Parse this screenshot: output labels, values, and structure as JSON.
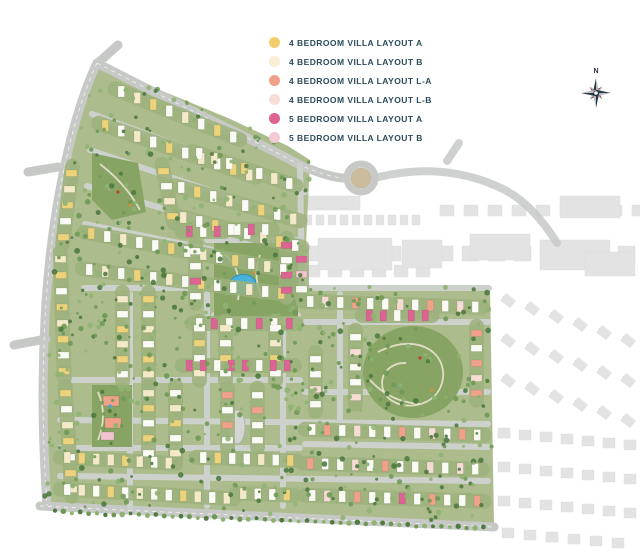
{
  "legend": {
    "items": [
      {
        "label": "4 BEDROOM VILLA LAYOUT A",
        "color": "#F1CE6E",
        "key": "Y"
      },
      {
        "label": "4 BEDROOM VILLA LAYOUT B",
        "color": "#F9EED2",
        "key": "C"
      },
      {
        "label": "4 BEDROOM VILLA LAYOUT L-A",
        "color": "#EFA189",
        "key": "S"
      },
      {
        "label": "4 BEDROOM VILLA LAYOUT L-B",
        "color": "#F8DCD6",
        "key": "P"
      },
      {
        "label": "5 BEDROOM VILLA LAYOUT A",
        "color": "#DB6492",
        "key": "M"
      },
      {
        "label": "5 BEDROOM VILLA LAYOUT B",
        "color": "#F4CBD4",
        "key": "R"
      }
    ]
  },
  "compass": {
    "north_label": "N"
  },
  "map": {
    "palette": {
      "Y": "#ECD27A",
      "C": "#F4EACA",
      "S": "#EFA189",
      "P": "#F6DCD4",
      "M": "#DB6492",
      "R": "#F2C3CE",
      "W": "#FBFBF5",
      "ground": "#ADBC8D",
      "street": "#CDD1CC",
      "road": "#C6C9C6",
      "strip": "#9DB27D",
      "park": "#87A464",
      "parkPath": "#E9E4CF",
      "water": "#48B2DA",
      "waterEdge": "#2E8CB8",
      "roundaboutCenter": "#CBBC9E",
      "context": "#C2C2C2",
      "contextRoad": "#C7C9C8",
      "trees": [
        "#4F7A40",
        "#6F9A55",
        "#8FB272"
      ],
      "island": "#D3D6D2",
      "islandEdge": "#AFB5AD"
    },
    "site_polygon": [
      [
        97,
        62
      ],
      [
        160,
        90
      ],
      [
        228,
        118
      ],
      [
        288,
        146
      ],
      [
        310,
        160
      ],
      [
        304,
        286
      ],
      [
        490,
        286
      ],
      [
        494,
        525
      ],
      [
        42,
        505
      ],
      [
        44,
        420
      ],
      [
        47,
        330
      ],
      [
        58,
        226
      ],
      [
        78,
        122
      ]
    ],
    "roads": [
      "M97,63 C160,96 242,134 302,166 C324,175 336,178 346,178",
      "M97,63 C70,120 50,220 45,320 C41,400 44,460 47,506",
      "M40,506 C160,512 300,518 494,527",
      "M99,62 L118,45",
      "M28,172 L58,167",
      "M14,345 L46,339"
    ],
    "context_roads": [
      "M375,178 C420,166 464,170 503,189 C527,201 544,222 557,243",
      "M447,161 L459,143"
    ],
    "roundabout": {
      "cx": 361,
      "cy": 178,
      "outer": 14,
      "inner": 10
    },
    "streets": [
      "M92,114 L305,192",
      "M90,150 L303,222",
      "M87,186 L302,250",
      "M85,224 L302,268",
      "M84,288 L489,288",
      "M130,294 L130,506",
      "M207,294 L207,506",
      "M283,320 L283,506",
      "M300,165 L302,288",
      "M207,240 L298,240",
      "M60,380 L300,380",
      "M305,322 L488,322",
      "M305,392 L488,392",
      "M60,420 L488,424",
      "M60,448 L300,448",
      "M305,444 L488,447",
      "M60,476 L488,481",
      "M340,294 L340,420",
      "M214,315 L298,315"
    ],
    "island": {
      "cx": 237,
      "cy": 427,
      "rx": 8,
      "ry": 17
    },
    "parks": [
      {
        "type": "poly",
        "pts": "92,153 138,163 146,212 112,220 92,200"
      },
      {
        "type": "rect",
        "x": 214,
        "y": 243,
        "w": 84,
        "h": 74
      },
      {
        "type": "rect",
        "x": 92,
        "y": 385,
        "w": 40,
        "h": 62
      },
      {
        "type": "ellipse",
        "cx": 413,
        "cy": 372,
        "rx": 50,
        "ry": 46
      }
    ],
    "park_paths": [
      "M100,164 Q126,184 140,210",
      "M222,252 Q244,268 238,300",
      "M260,255 Q252,275 262,298",
      "M98,392 Q108,415 98,440",
      "M378,352 C420,330 452,356 441,386 C432,410 394,412 384,392 C377,376 390,362 406,363",
      "M370,380 Q390,402 420,404"
    ],
    "park_buildings": [
      {
        "x": 103,
        "y": 396,
        "w": 16,
        "h": 10,
        "key": "S"
      },
      {
        "x": 105,
        "y": 418,
        "w": 16,
        "h": 10,
        "key": "S"
      },
      {
        "x": 101,
        "y": 432,
        "w": 13,
        "h": 8,
        "key": "R"
      }
    ],
    "pond": {
      "cx": 243,
      "cy": 284,
      "rx": 13,
      "ry": 9.5
    },
    "specks": [
      [
        118,
        192,
        "#B8432F"
      ],
      [
        130,
        205,
        "#D98F3E"
      ],
      [
        255,
        260,
        "#B8432F"
      ],
      [
        228,
        262,
        "#3FA8D8"
      ],
      [
        420,
        358,
        "#B8432F"
      ],
      [
        400,
        386,
        "#3FA8D8"
      ],
      [
        432,
        390,
        "#D98F3E"
      ],
      [
        110,
        406,
        "#3FA8D8"
      ],
      [
        254,
        272,
        "#D98F3E"
      ]
    ],
    "villa_rows": [
      [
        118,
        86,
        16,
        6.5,
        8,
        "v",
        "WCYWCWYW"
      ],
      [
        102,
        120,
        16,
        5.5,
        10,
        "v",
        "YWCWYWCWYC"
      ],
      [
        196,
        148,
        15,
        5,
        7,
        "v",
        "WCWYWCW"
      ],
      [
        158,
        168,
        3,
        15,
        4,
        "h",
        "YWCY"
      ],
      [
        178,
        182,
        16,
        4.5,
        8,
        "v",
        "WYWCWYWC"
      ],
      [
        180,
        212,
        16,
        4,
        8,
        "v",
        "CWYWWCYW"
      ],
      [
        88,
        228,
        16,
        3,
        13,
        "v",
        "YWCWWYWCWYWCW"
      ],
      [
        86,
        264,
        16,
        2,
        13,
        "v",
        "WCWYWCWYWWCWY"
      ],
      [
        66,
        170,
        -2,
        16,
        5,
        "h",
        "YCYWY"
      ],
      [
        55,
        256,
        0.5,
        16,
        8,
        "h",
        "CYWYCYWY"
      ],
      [
        60,
        390,
        1,
        16,
        7,
        "h",
        "YWCYWYC"
      ],
      [
        186,
        226,
        14,
        0,
        3,
        "v",
        "MWM"
      ],
      [
        234,
        224,
        14,
        0,
        3,
        "v",
        "WMW"
      ],
      [
        190,
        248,
        0,
        15,
        4,
        "h",
        "WWMW"
      ],
      [
        281,
        242,
        0,
        15,
        4,
        "h",
        "MWMM"
      ],
      [
        296,
        256,
        0,
        15,
        3,
        "h",
        "MRW"
      ],
      [
        196,
        318,
        15,
        0,
        4,
        "v",
        "WMWW"
      ],
      [
        256,
        318,
        15,
        0,
        3,
        "v",
        "MWM"
      ],
      [
        307,
        296,
        15,
        0.5,
        12,
        "v",
        "WPWSWWPWSWPW"
      ],
      [
        366,
        310,
        14,
        0,
        5,
        "v",
        "MMWMM"
      ],
      [
        350,
        334,
        0,
        15,
        5,
        "h",
        "WPWWP"
      ],
      [
        471,
        330,
        0,
        15,
        5,
        "h",
        "SWSPS"
      ],
      [
        310,
        356,
        0,
        15,
        4,
        "h",
        "WWPW"
      ],
      [
        309,
        424,
        15,
        0.5,
        12,
        "v",
        "WSWPWWSWPWSW"
      ],
      [
        307,
        458,
        15,
        0.5,
        12,
        "v",
        "SWWPWSWWPWPW"
      ],
      [
        309,
        490,
        15,
        0.5,
        12,
        "v",
        "WPWSWWMWSWWS"
      ],
      [
        117,
        296,
        0,
        15,
        6,
        "h",
        "CWYCYW"
      ],
      [
        143,
        296,
        0,
        15,
        6,
        "h",
        "YWCWYC"
      ],
      [
        194,
        325,
        0,
        15,
        4,
        "h",
        "WYWC"
      ],
      [
        220,
        325,
        0,
        15,
        4,
        "h",
        "CWYW"
      ],
      [
        270,
        325,
        0,
        15,
        4,
        "h",
        "WCYW"
      ],
      [
        186,
        360,
        14,
        0,
        8,
        "v",
        "MMWMMWMM"
      ],
      [
        143,
        390,
        0,
        15,
        5,
        "h",
        "CYWYW"
      ],
      [
        170,
        390,
        0,
        15,
        5,
        "h",
        "WCYWC"
      ],
      [
        222,
        392,
        0,
        15,
        4,
        "h",
        "SWSW"
      ],
      [
        252,
        392,
        0,
        15,
        4,
        "h",
        "WSWW"
      ],
      [
        64,
        452,
        14.5,
        0.8,
        8,
        "v",
        "CYCCYCWC"
      ],
      [
        200,
        452,
        14.5,
        0.5,
        7,
        "v",
        "WYWWCWY"
      ],
      [
        64,
        484,
        14.5,
        0.8,
        12,
        "v",
        "WCWYWCWWYCWC"
      ],
      [
        240,
        488,
        14.5,
        0.5,
        4,
        "v",
        "CWWY"
      ]
    ],
    "context_strips": [
      {
        "x0": 304,
        "y": 215,
        "x1": 418,
        "step": 12,
        "w": 8,
        "h": 10
      },
      {
        "x0": 306,
        "y": 246,
        "x1": 644,
        "step": 26,
        "w": 17,
        "h": 15
      },
      {
        "x0": 440,
        "y": 205,
        "x1": 640,
        "step": 24,
        "w": 14,
        "h": 11
      },
      {
        "x0": 306,
        "y": 265,
        "x1": 420,
        "step": 22,
        "w": 14,
        "h": 12
      }
    ],
    "context_blocks": [
      [
        318,
        238,
        74,
        32
      ],
      [
        402,
        240,
        40,
        28
      ],
      [
        470,
        234,
        60,
        26
      ],
      [
        560,
        196,
        60,
        22
      ],
      [
        540,
        240,
        70,
        30
      ],
      [
        308,
        196,
        52,
        14
      ],
      [
        585,
        252,
        50,
        24
      ]
    ],
    "context_house_rows": [
      {
        "x": 502,
        "y": 296,
        "count": 6,
        "step": 24,
        "dy": 8,
        "w": 12,
        "h": 9,
        "rot": 38
      },
      {
        "x": 502,
        "y": 336,
        "count": 6,
        "step": 24,
        "dy": 8,
        "w": 12,
        "h": 9,
        "rot": 38
      },
      {
        "x": 502,
        "y": 376,
        "count": 6,
        "step": 24,
        "dy": 8,
        "w": 12,
        "h": 9,
        "rot": 38
      },
      {
        "x": 498,
        "y": 428,
        "count": 7,
        "step": 21,
        "dy": 2,
        "w": 12,
        "h": 10,
        "rot": 0
      },
      {
        "x": 498,
        "y": 462,
        "count": 7,
        "step": 21,
        "dy": 2,
        "w": 12,
        "h": 10,
        "rot": 0
      },
      {
        "x": 498,
        "y": 496,
        "count": 7,
        "step": 21,
        "dy": 2,
        "w": 12,
        "h": 10,
        "rot": 0
      },
      {
        "x": 502,
        "y": 528,
        "count": 6,
        "step": 22,
        "dy": 2,
        "w": 12,
        "h": 10,
        "rot": 0
      }
    ],
    "tree_count": 620,
    "road_tree_count": 52
  }
}
